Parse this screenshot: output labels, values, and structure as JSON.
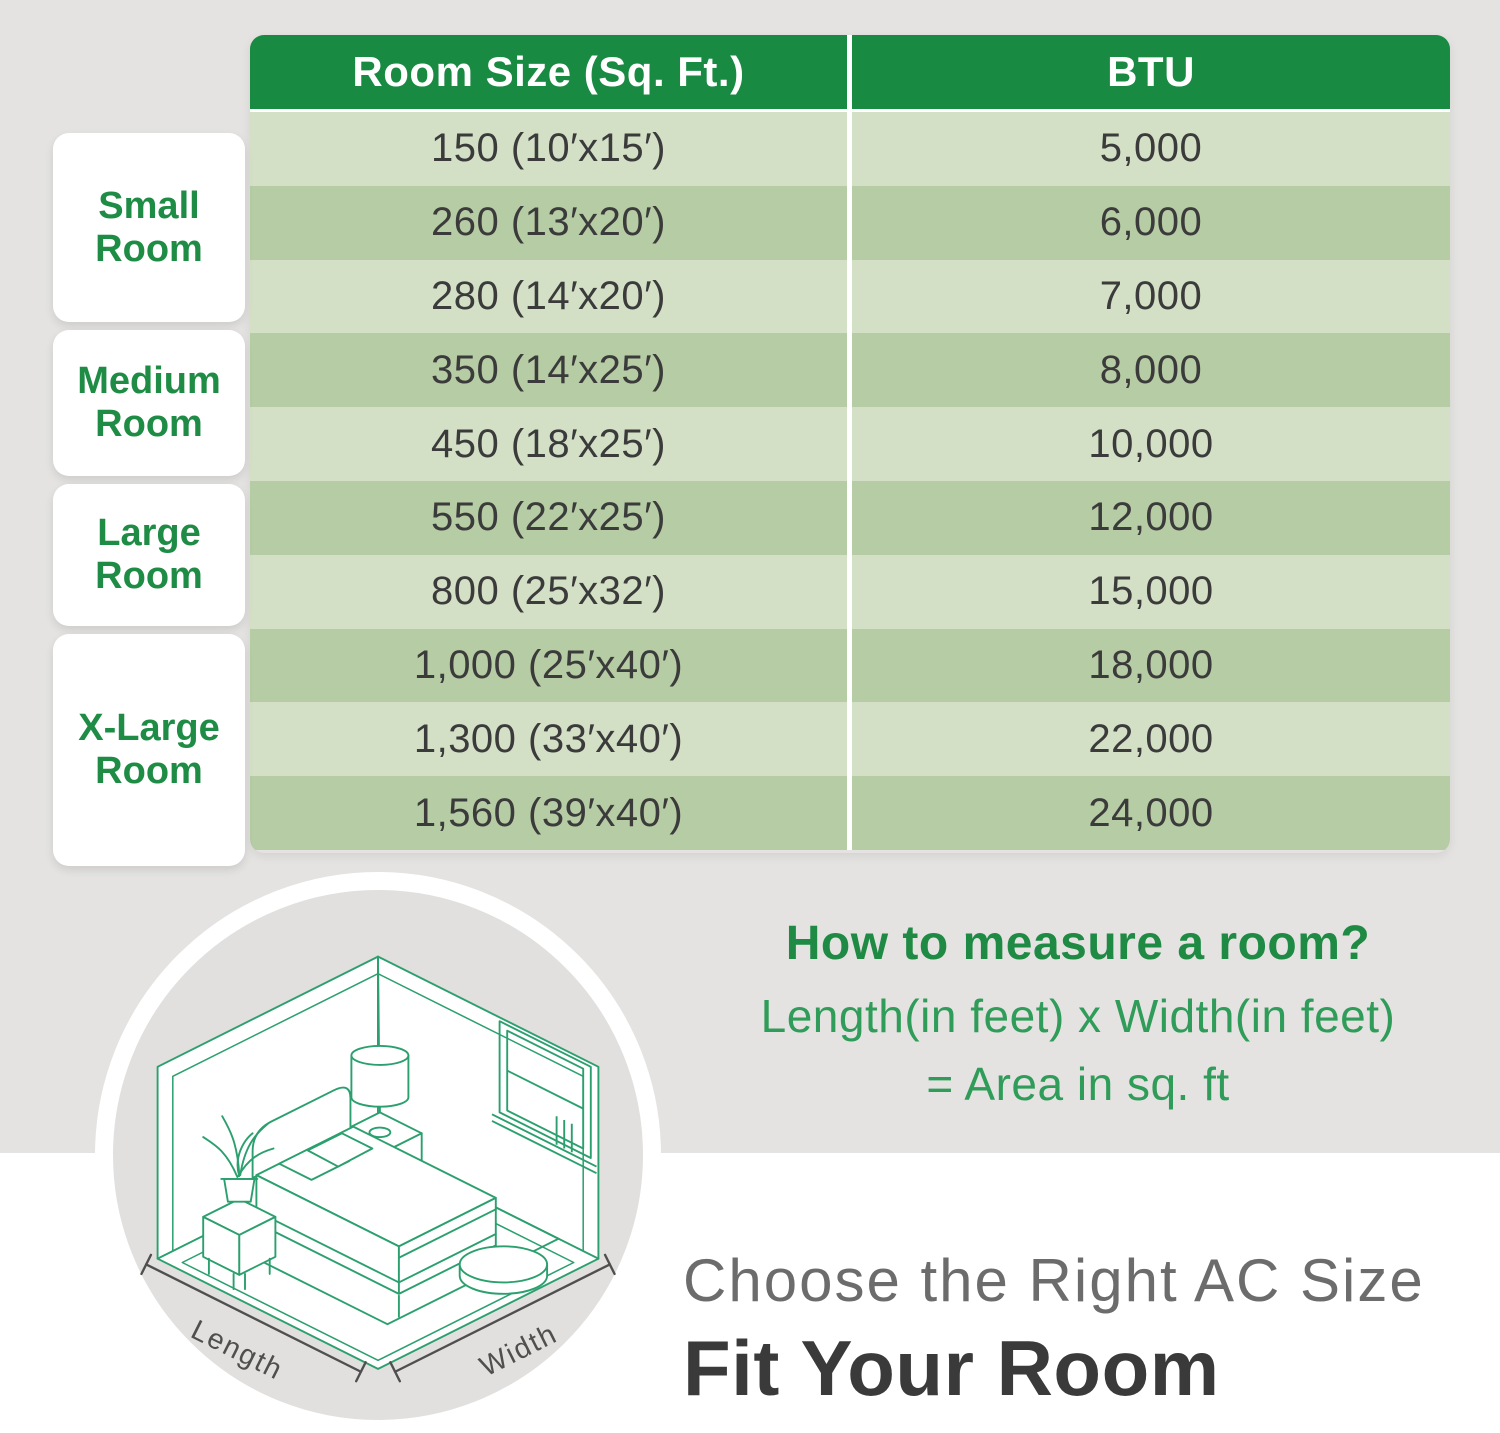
{
  "table": {
    "headers": {
      "room_size": "Room Size (Sq. Ft.)",
      "btu": "BTU"
    },
    "rows": [
      {
        "size": "150 (10′x15′)",
        "btu": "5,000"
      },
      {
        "size": "260 (13′x20′)",
        "btu": "6,000"
      },
      {
        "size": "280 (14′x20′)",
        "btu": "7,000"
      },
      {
        "size": "350 (14′x25′)",
        "btu": "8,000"
      },
      {
        "size": "450 (18′x25′)",
        "btu": "10,000"
      },
      {
        "size": "550 (22′x25′)",
        "btu": "12,000"
      },
      {
        "size": "800 (25′x32′)",
        "btu": "15,000"
      },
      {
        "size": "1,000 (25′x40′)",
        "btu": "18,000"
      },
      {
        "size": "1,300 (33′x40′)",
        "btu": "22,000"
      },
      {
        "size": "1,560 (39′x40′)",
        "btu": "24,000"
      }
    ]
  },
  "room_categories": [
    {
      "label": "Small Room"
    },
    {
      "label": "Medium Room"
    },
    {
      "label": "Large Room"
    },
    {
      "label": "X-Large Room"
    }
  ],
  "measure_info": {
    "title": "How to measure a room?",
    "formula_line1": "Length(in feet) x Width(in feet)",
    "formula_line2": "= Area in sq. ft"
  },
  "illustration": {
    "length_label": "Length",
    "width_label": "Width"
  },
  "footer": {
    "subtitle": "Choose the Right AC Size",
    "title": "Fit Your Room"
  },
  "colors": {
    "header_green": "#188a42",
    "row_light": "#d3e0c6",
    "row_dark": "#b6cca4",
    "accent_green": "#1e8c45",
    "formula_green": "#309c59",
    "illustration_line_green": "#2ba06e",
    "background_gray": "#e4e3e1",
    "dimension_gray": "#4f4f4f",
    "footer_subtitle_gray": "#6c6c6c",
    "footer_title_gray": "#3a3a3a"
  }
}
